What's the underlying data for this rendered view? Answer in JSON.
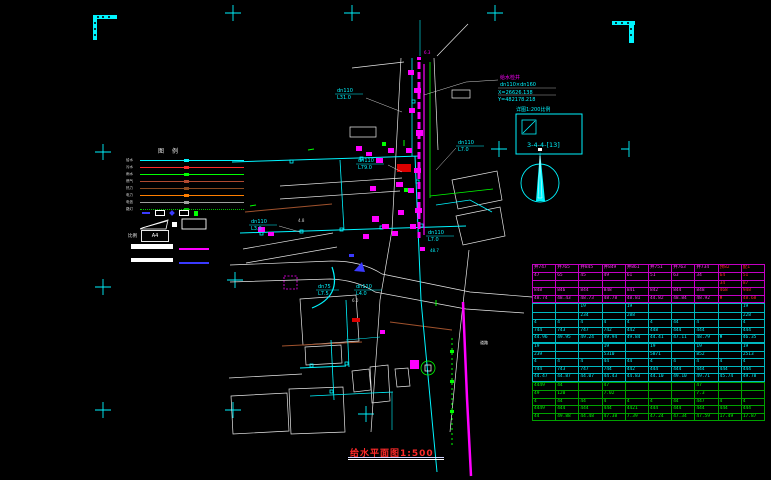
{
  "colors": {
    "bg": "#000000",
    "cyan": "#00f5ff",
    "magenta": "#ff00ff",
    "green": "#00ff00",
    "red": "#ff2a2a",
    "white": "#ffffff"
  },
  "title": {
    "text": "给水平面图1:500"
  },
  "annotation": {
    "name": "给水检井",
    "dn": "dn110×dn160",
    "x": "X=26626.138",
    "y": "Y=482178.218"
  },
  "detail_box": {
    "caption": "详图1:200比例",
    "code": "3-4-4-[13]"
  },
  "pipe_labels": [
    {
      "dn": "dn110",
      "len": "L31.0"
    },
    {
      "dn": "dn110",
      "len": "L79.0"
    },
    {
      "dn": "dn110",
      "len": "L3.0"
    },
    {
      "dn": "dn75",
      "len": "L7.5"
    },
    {
      "dn": "dn110",
      "len": "L4.0"
    },
    {
      "dn": "dn110",
      "len": "L7.0"
    },
    {
      "dn": "dn110",
      "len": "L7.0"
    }
  ],
  "legend": {
    "title_left": "图",
    "title_right": "例",
    "rows": [
      {
        "label": "给水",
        "color": "#00f5ff"
      },
      {
        "label": "污水",
        "color": "#ff2a2a"
      },
      {
        "label": "雨水",
        "color": "#00ff00"
      },
      {
        "label": "燃气",
        "color": "#b04a30"
      },
      {
        "label": "热力",
        "color": "#8a4a20"
      },
      {
        "label": "电力",
        "color": "#ff7f00"
      },
      {
        "label": "电信",
        "color": "#9e9e9e"
      },
      {
        "label": "路灯",
        "color": "#00c000",
        "dotted": true
      }
    ],
    "scale_label": "比例",
    "paper_label": "A4"
  },
  "drawing_texts": {
    "road": "道路",
    "e1": "4.8",
    "e2": "6.0",
    "e3": "48.7",
    "m1": "6.3"
  },
  "table": {
    "sections": [
      {
        "text": "#ff3df2",
        "border": "#c400c4",
        "red_cols": [
          8,
          9
        ],
        "rows": [
          [
            "井747",
            "井765",
            "井845",
            "井849",
            "井861",
            "井751",
            "井763",
            "井734",
            "预82",
            "配1"
          ],
          [
            "47",
            "65",
            "45",
            "49",
            "61",
            "51",
            "63",
            "34",
            "64",
            "51"
          ],
          [
            "",
            "",
            "",
            "",
            "",
            "",
            "",
            "",
            "34",
            "87"
          ],
          [
            "848",
            "846",
            "844",
            "848",
            "841",
            "842",
            "844",
            "848",
            "468",
            "948"
          ],
          [
            "48.74",
            "48.43",
            "48.73",
            "48.78",
            "48.81",
            "44.82",
            "48.84",
            "48.92",
            "Φ",
            "48.68"
          ]
        ]
      },
      {
        "text": "#00f5ff",
        "border": "#00b8c0",
        "rows": [
          [
            "",
            "",
            "19",
            "",
            "19",
            "",
            "",
            "",
            "",
            "19"
          ],
          [
            "",
            "",
            "234",
            "",
            "288",
            "",
            "",
            "",
            "",
            "228"
          ],
          [
            "4",
            "4",
            "4",
            "4",
            "4",
            "4",
            "44",
            "4",
            "",
            "4"
          ],
          [
            "744",
            "743",
            "747",
            "742",
            "442",
            "448",
            "444",
            "444",
            "",
            "444"
          ],
          [
            "44.96",
            "49.95",
            "49.24",
            "49.94",
            "49.84",
            "44.41",
            "47.11",
            "48.79",
            "Φ",
            "46.35"
          ]
        ]
      },
      {
        "text": "#00f5ff",
        "border": "#00b8c0",
        "rows": [
          [
            "19",
            "",
            "",
            "19",
            "",
            "19",
            "",
            "19",
            "",
            "19"
          ],
          [
            "239",
            "",
            "",
            "5310",
            "",
            "5871",
            "",
            "852",
            "",
            "2513"
          ],
          [
            "4",
            "4",
            "4",
            "44",
            "44",
            "4",
            "4",
            "4",
            "4",
            "4"
          ],
          [
            "744",
            "743",
            "747",
            "744",
            "442",
            "444",
            "444",
            "444",
            "444",
            "444"
          ],
          [
            "44.47",
            "44.87",
            "44.07",
            "44.43",
            "44.83",
            "44.10",
            "49.10",
            "49.71",
            "45.74",
            "49.78"
          ]
        ]
      },
      {
        "text": "#00ff00",
        "border": "#00a000",
        "rows": [
          [
            "4449",
            "44",
            "",
            "47",
            "",
            "",
            "",
            "47",
            "",
            ""
          ],
          [
            "49",
            "120",
            "",
            "7.02",
            "",
            "",
            "",
            "7.3",
            "",
            ""
          ],
          [
            "4",
            "44",
            "44",
            "4",
            "4",
            "4",
            "44",
            "447",
            "4",
            "4"
          ],
          [
            "4449",
            "444",
            "444",
            "444",
            "4421",
            "444",
            "444",
            "444",
            "444",
            "444"
          ],
          [
            "44",
            "49.88",
            "44.48",
            "47.38",
            "7.39",
            "47.24",
            "47.34",
            "47.59",
            "17.49",
            "17.87"
          ]
        ]
      }
    ]
  }
}
